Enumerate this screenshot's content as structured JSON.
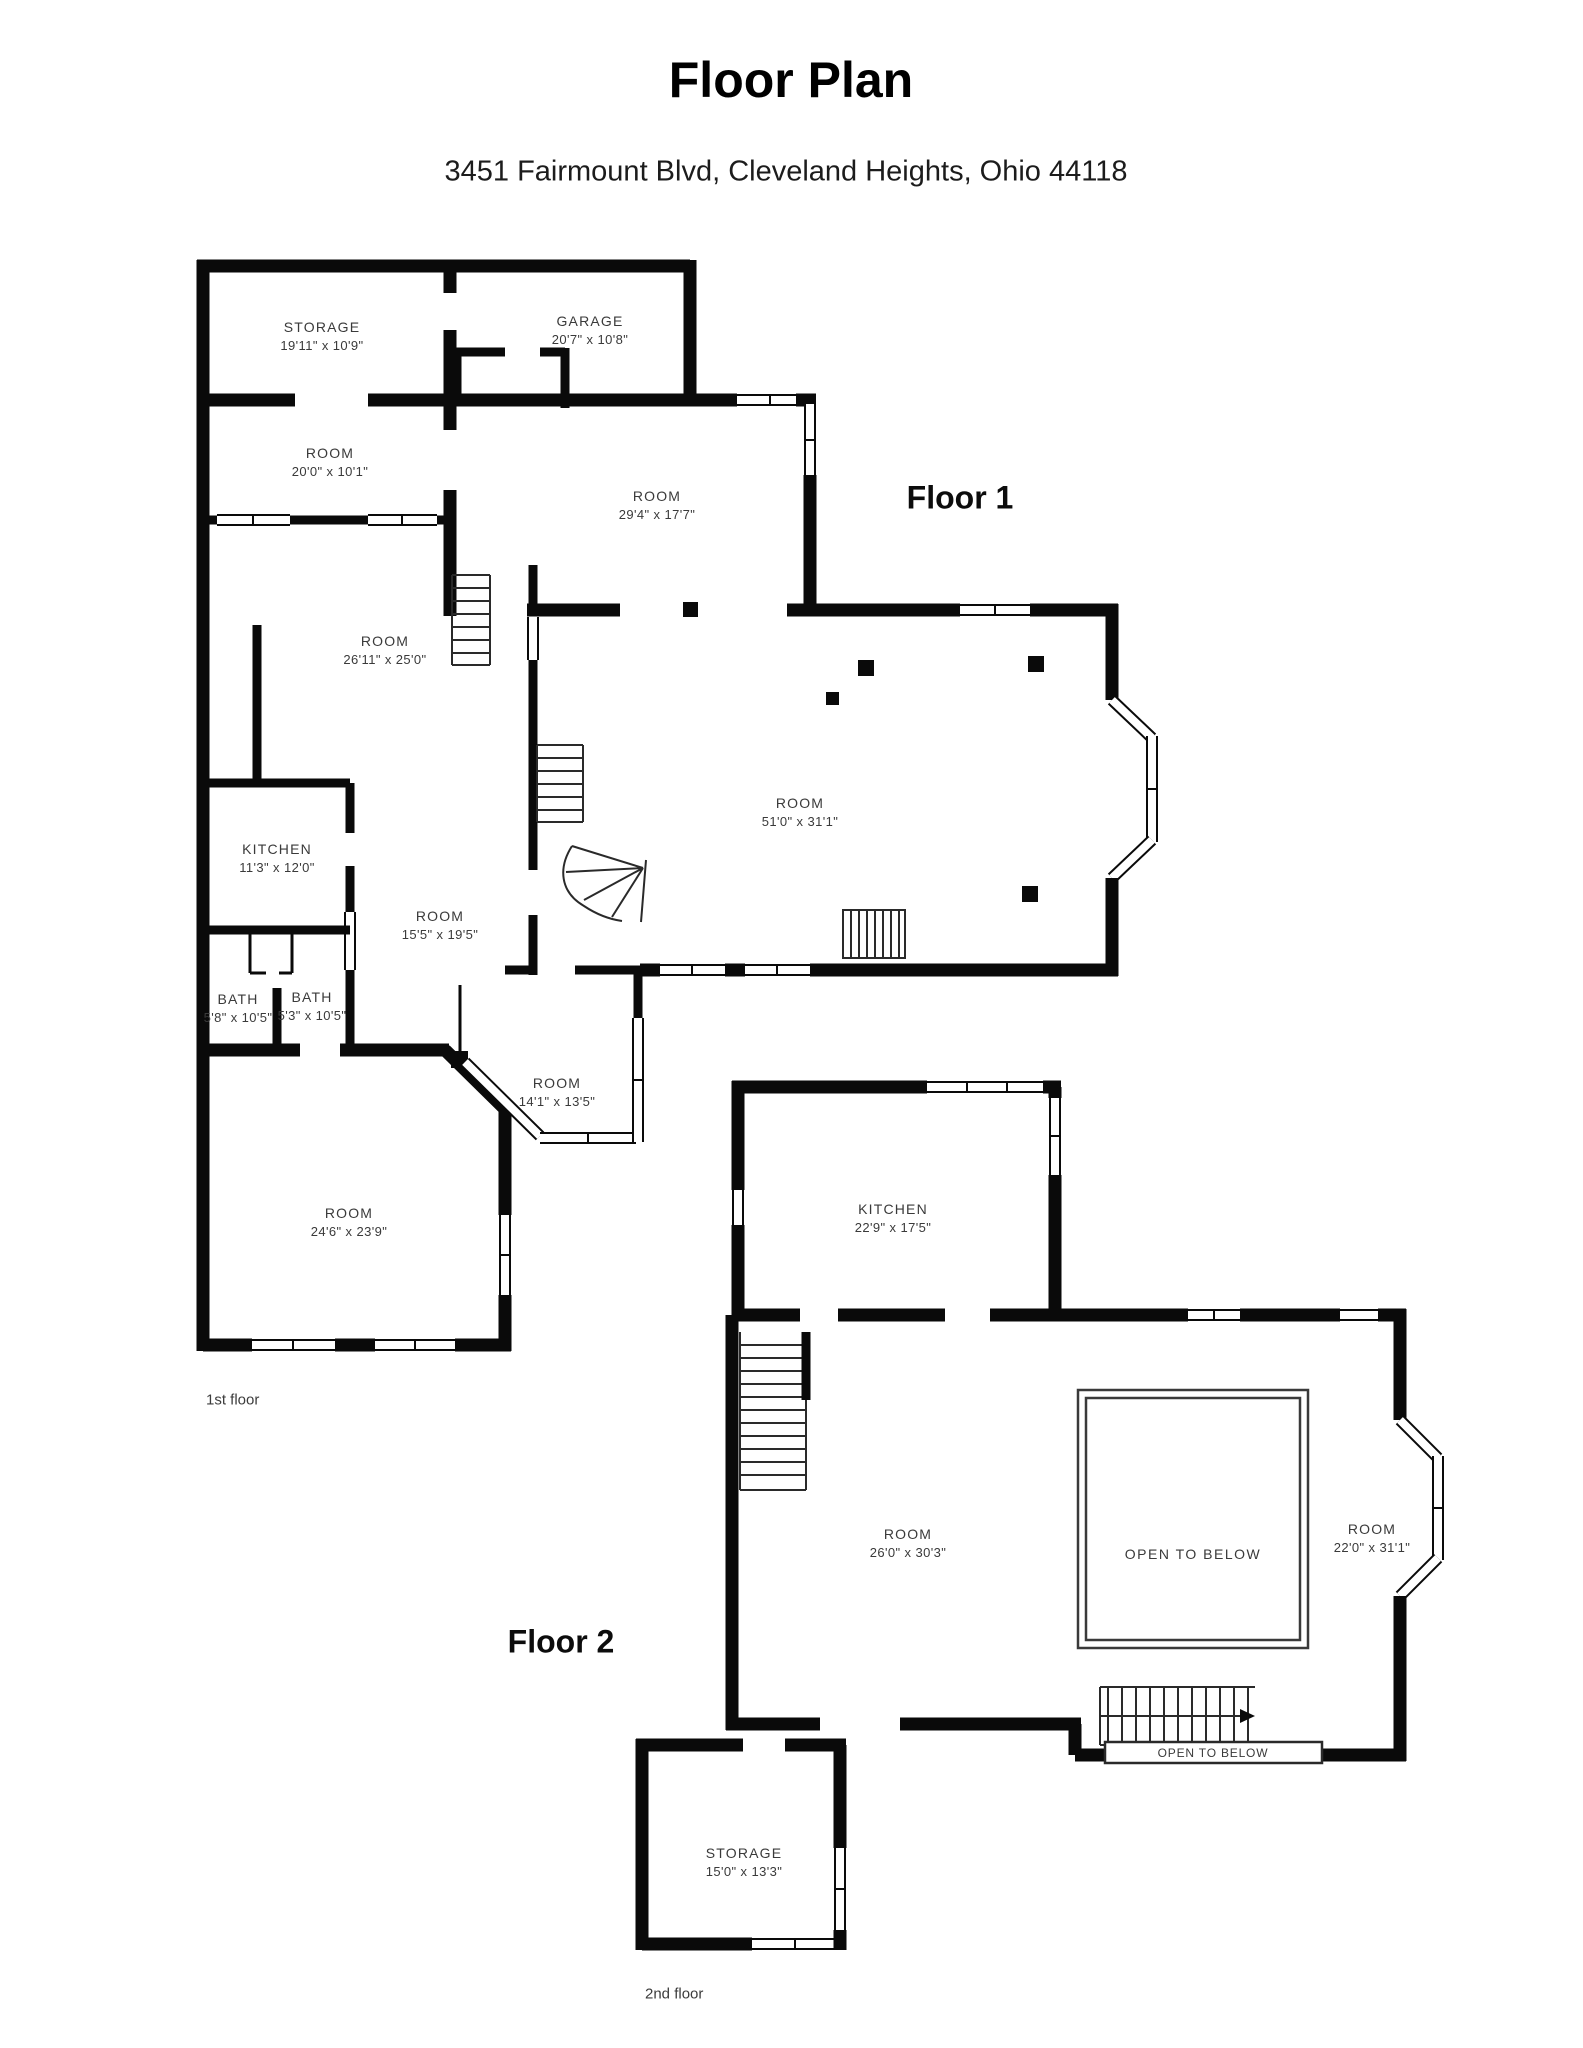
{
  "page": {
    "title": "Floor Plan",
    "address": "3451 Fairmount Blvd, Cleveland Heights, Ohio 44118"
  },
  "floor1": {
    "heading": "Floor 1",
    "caption": "1st floor",
    "rooms": {
      "storage": {
        "label": "STORAGE",
        "dims": "19'11\" x 10'9\""
      },
      "garage": {
        "label": "GARAGE",
        "dims": "20'7\" x 10'8\""
      },
      "room_20x10": {
        "label": "ROOM",
        "dims": "20'0\" x 10'1\""
      },
      "room_29x17": {
        "label": "ROOM",
        "dims": "29'4\" x 17'7\""
      },
      "room_26x25": {
        "label": "ROOM",
        "dims": "26'11\" x 25'0\""
      },
      "room_51x31": {
        "label": "ROOM",
        "dims": "51'0\" x 31'1\""
      },
      "kitchen": {
        "label": "KITCHEN",
        "dims": "11'3\" x 12'0\""
      },
      "room_15x19": {
        "label": "ROOM",
        "dims": "15'5\" x 19'5\""
      },
      "bath_left": {
        "label": "BATH",
        "dims": "5'8\" x 10'5\""
      },
      "bath_right": {
        "label": "BATH",
        "dims": "5'3\" x 10'5\""
      },
      "room_14x13": {
        "label": "ROOM",
        "dims": "14'1\" x 13'5\""
      },
      "room_24x23": {
        "label": "ROOM",
        "dims": "24'6\" x 23'9\""
      }
    }
  },
  "floor2": {
    "heading": "Floor 2",
    "caption": "2nd floor",
    "rooms": {
      "kitchen": {
        "label": "KITCHEN",
        "dims": "22'9\" x 17'5\""
      },
      "room_26x30": {
        "label": "ROOM",
        "dims": "26'0\" x 30'3\""
      },
      "open_below": {
        "label": "OPEN TO BELOW"
      },
      "room_22x31": {
        "label": "ROOM",
        "dims": "22'0\" x 31'1\""
      },
      "open_below_strip": {
        "label": "OPEN TO BELOW"
      },
      "storage": {
        "label": "STORAGE",
        "dims": "15'0\" x 13'3\""
      }
    }
  }
}
